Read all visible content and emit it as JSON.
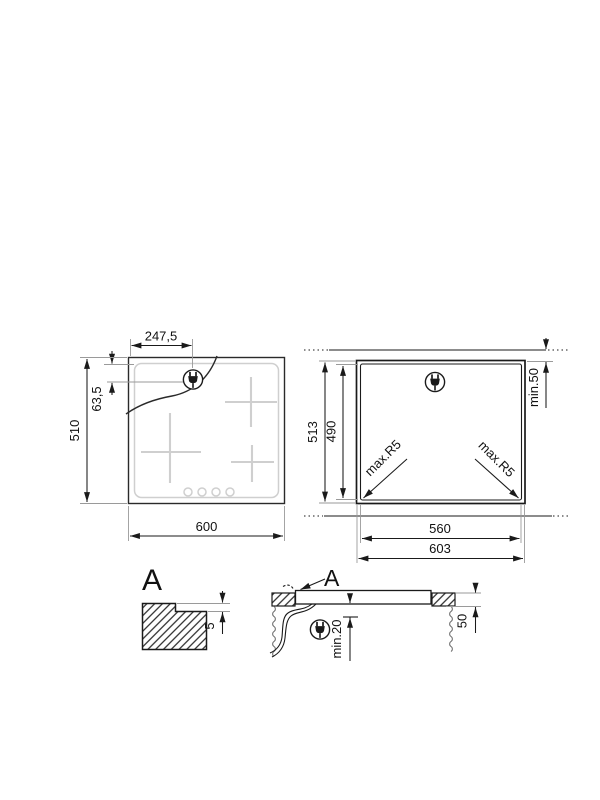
{
  "plan_view": {
    "dim_plug_offset_x": "247,5",
    "dim_plug_offset_y": "63,5",
    "dim_depth": "510",
    "dim_width": "600"
  },
  "cutout_view": {
    "dim_overall_depth": "513",
    "dim_cutout_depth": "490",
    "dim_rear_clearance": "min.50",
    "dim_corner_radius_left": "max.R5",
    "dim_corner_radius_right": "max.R5",
    "dim_cutout_width": "560",
    "dim_overall_width": "603"
  },
  "detail_view": {
    "label": "A",
    "dim_rebate_depth": "5"
  },
  "section_view": {
    "detail_ref_label": "A",
    "dim_clearance_below": "min.20",
    "dim_recess_depth": "50"
  },
  "colors": {
    "line": "#1a1a1a",
    "extension_line": "#9a9a9a",
    "light_marks": "#cfcfcf"
  }
}
